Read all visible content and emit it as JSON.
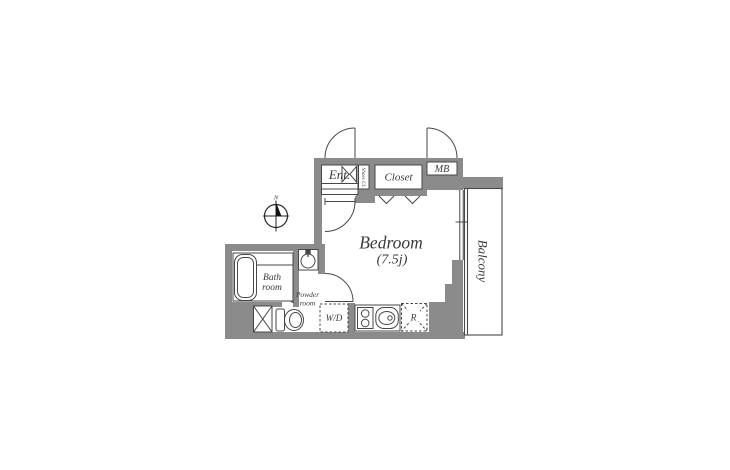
{
  "floorplan": {
    "labels": {
      "entrance": "Ent.",
      "shoes_closet": "Shoes Cl.",
      "closet": "Closet",
      "meter_box": "MB",
      "bedroom_name": "Bedroom",
      "bedroom_size": "(7.5j)",
      "balcony": "Balcony",
      "bath_line1": "Bath",
      "bath_line2": "room",
      "powder_line1": "Powder",
      "powder_line2": "room",
      "washer_dryer": "W/D",
      "refrigerator": "R",
      "compass_north": "N"
    },
    "colors": {
      "wall": "#8b8b8b",
      "line": "#474747",
      "text": "#3a3a3a",
      "background": "#ffffff"
    }
  }
}
